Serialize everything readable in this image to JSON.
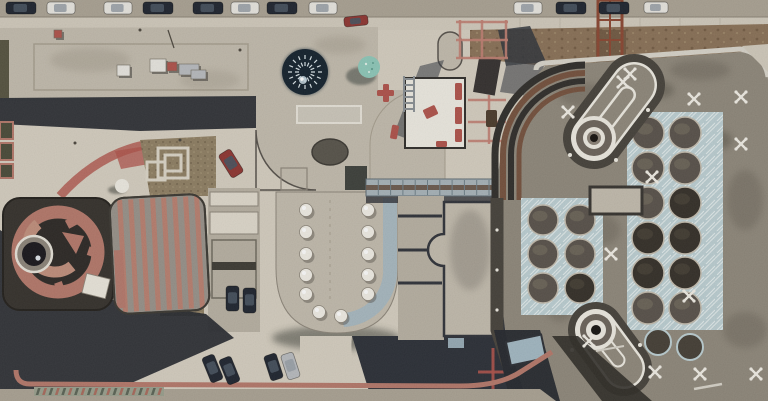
{
  "meta": {
    "title": "Aerial rooftop view of museum complex",
    "description": "Top-down drone photograph of a building complex: concrete rooftops, a dark radial skylight dome, a teal dome, a spiral rotunda on a dark square roof, a pink-striped barrel hall, a U-shaped roof with bubble skylights, a glass bridge, and a large taupe roof with keyhole-shaped structures, dome skylight grids with pale blue patterned spandrels and white X markers. Cars are parked along the top street and lower plaza."
  },
  "palette": {
    "plaza": "#d6cfc1",
    "plaza_bright": "#e0dacd",
    "concrete": "#c3bcae",
    "concrete2": "#b8b1a3",
    "street": "#aba394",
    "sidewalk": "#d2cbbd",
    "shadow": "#23262c",
    "navy": "#2a2e36",
    "roof_taupe": "#8f887b",
    "roof_dark": "#45413a",
    "terracotta": "#b5786a",
    "pink": "#bb7e6e",
    "red_paint": "#b0524a",
    "red_line": "#c17f72",
    "brick_red": "#8f3430",
    "dirt": "#8a7157",
    "dirt_dark": "#6e5640",
    "teal": "#8ec9ba",
    "dome_navy": "#12202c",
    "blue_pattern": "#bdd0d4",
    "blue_glass": "#a3b9c4",
    "white": "#efece3",
    "car_dark": "#1d232e",
    "car_white": "#e9e7e1",
    "car_silver": "#b9bcc0",
    "rust": "#8a4530",
    "gravel": "#8f7f63",
    "charcoal": "#2e2c29",
    "brown_stripe": "#74503c",
    "silver_edge": "#d9d5cb",
    "hall_gray": "#98928a"
  },
  "scene": {
    "cars": [
      {
        "x": 6,
        "y": 2,
        "w": 30,
        "h": 12,
        "a": 0,
        "color": "car_dark"
      },
      {
        "x": 47,
        "y": 2,
        "w": 28,
        "h": 12,
        "a": 0,
        "color": "car_white"
      },
      {
        "x": 104,
        "y": 2,
        "w": 28,
        "h": 12,
        "a": 0,
        "color": "car_white"
      },
      {
        "x": 143,
        "y": 2,
        "w": 30,
        "h": 12,
        "a": 0,
        "color": "car_dark"
      },
      {
        "x": 193,
        "y": 2,
        "w": 30,
        "h": 12,
        "a": 0,
        "color": "car_dark"
      },
      {
        "x": 231,
        "y": 2,
        "w": 28,
        "h": 12,
        "a": 0,
        "color": "car_white"
      },
      {
        "x": 267,
        "y": 2,
        "w": 30,
        "h": 12,
        "a": 0,
        "color": "car_dark"
      },
      {
        "x": 309,
        "y": 2,
        "w": 28,
        "h": 12,
        "a": 0,
        "color": "car_white"
      },
      {
        "x": 514,
        "y": 2,
        "w": 28,
        "h": 12,
        "a": 0,
        "color": "car_white"
      },
      {
        "x": 556,
        "y": 2,
        "w": 30,
        "h": 12,
        "a": 0,
        "color": "car_dark"
      },
      {
        "x": 599,
        "y": 2,
        "w": 30,
        "h": 12,
        "a": 0,
        "color": "car_dark"
      },
      {
        "x": 644,
        "y": 2,
        "w": 24,
        "h": 11,
        "a": 0,
        "color": "car_white"
      },
      {
        "x": 344,
        "y": 16,
        "w": 24,
        "h": 10,
        "a": -6,
        "color": "brick_red"
      },
      {
        "x": 224,
        "y": 150,
        "w": 14,
        "h": 27,
        "a": -32,
        "color": "brick_red"
      },
      {
        "x": 226,
        "y": 286,
        "w": 13,
        "h": 25,
        "a": 0,
        "color": "car_dark"
      },
      {
        "x": 243,
        "y": 288,
        "w": 13,
        "h": 25,
        "a": 0,
        "color": "car_dark"
      },
      {
        "x": 206,
        "y": 355,
        "w": 13,
        "h": 27,
        "a": -22,
        "color": "car_dark"
      },
      {
        "x": 223,
        "y": 357,
        "w": 13,
        "h": 27,
        "a": -22,
        "color": "car_dark"
      },
      {
        "x": 267,
        "y": 354,
        "w": 13,
        "h": 26,
        "a": -18,
        "color": "car_dark"
      },
      {
        "x": 284,
        "y": 353,
        "w": 13,
        "h": 26,
        "a": -18,
        "color": "car_silver"
      }
    ],
    "hvac_units": [
      {
        "x": 150,
        "y": 59,
        "w": 16,
        "h": 13,
        "color": "car_white"
      },
      {
        "x": 167,
        "y": 62,
        "w": 10,
        "h": 9,
        "color": "red_paint"
      },
      {
        "x": 179,
        "y": 64,
        "w": 20,
        "h": 11,
        "color": "car_silver"
      },
      {
        "x": 191,
        "y": 70,
        "w": 15,
        "h": 9,
        "color": "car_silver"
      },
      {
        "x": 117,
        "y": 65,
        "w": 13,
        "h": 11,
        "color": "car_white"
      },
      {
        "x": 54,
        "y": 30,
        "w": 8,
        "h": 8,
        "color": "red_paint"
      }
    ],
    "striped_hall": {
      "x0": 120,
      "step": 11,
      "count": 8,
      "y": 198,
      "h": 112,
      "w": 5
    },
    "dome_spokes": {
      "cx": 305,
      "cy": 72,
      "r": 23,
      "count": 16
    },
    "skylight_bubbles": {
      "left_x": 306,
      "right_x": 368,
      "rows": [
        210,
        232,
        254,
        275,
        294
      ],
      "arc": [
        [
          319,
          312
        ],
        [
          341,
          316
        ]
      ],
      "radius": 6.5
    },
    "dome_clusters": [
      {
        "field": [
          521,
          198,
          82,
          117
        ],
        "cols": [
          543,
          580
        ],
        "rows": [
          220,
          254,
          288
        ],
        "r": 15,
        "sooty": [
          [
            580,
            288
          ]
        ]
      },
      {
        "field": [
          627,
          112,
          96,
          218
        ],
        "cols": [
          648,
          685
        ],
        "rows": [
          133,
          168,
          203,
          238,
          273,
          308
        ],
        "r": 16,
        "sooty": [
          [
            648,
            238
          ],
          [
            685,
            238
          ],
          [
            648,
            273
          ],
          [
            685,
            273
          ],
          [
            685,
            203
          ]
        ]
      }
    ],
    "extra_domes": [
      [
        658,
        342
      ],
      [
        690,
        347
      ]
    ],
    "x_marks": [
      [
        623,
        82
      ],
      [
        694,
        99
      ],
      [
        741,
        97
      ],
      [
        741,
        144
      ],
      [
        652,
        177
      ],
      [
        568,
        112
      ],
      [
        630,
        74
      ],
      [
        689,
        296
      ],
      [
        655,
        372
      ],
      [
        700,
        374
      ],
      [
        756,
        374
      ],
      [
        589,
        341
      ],
      [
        611,
        254
      ]
    ],
    "red_furniture": [
      {
        "x": 377,
        "y": 90,
        "w": 17,
        "h": 6,
        "a": 0
      },
      {
        "x": 383,
        "y": 84,
        "w": 6,
        "h": 18,
        "a": 0
      },
      {
        "x": 455,
        "y": 83,
        "w": 7,
        "h": 17,
        "a": 0
      },
      {
        "x": 455,
        "y": 107,
        "w": 7,
        "h": 17,
        "a": 0
      },
      {
        "x": 455,
        "y": 129,
        "w": 7,
        "h": 13,
        "a": 0
      },
      {
        "x": 424,
        "y": 107,
        "w": 13,
        "h": 10,
        "a": -25
      },
      {
        "x": 391,
        "y": 125,
        "w": 7,
        "h": 14,
        "a": 10
      },
      {
        "x": 436,
        "y": 141,
        "w": 11,
        "h": 6,
        "a": 0
      }
    ],
    "red_grid": {
      "verticals": [
        [
          460,
          20,
          58
        ],
        [
          482,
          20,
          58
        ],
        [
          506,
          20,
          58
        ],
        [
          489,
          95,
          144
        ]
      ],
      "horizontals": [
        [
          456,
          508,
          22
        ],
        [
          456,
          508,
          40
        ],
        [
          456,
          508,
          58
        ],
        [
          468,
          506,
          100
        ],
        [
          468,
          506,
          122
        ],
        [
          468,
          506,
          141
        ]
      ]
    },
    "crosswalk": {
      "x": 36,
      "y": 387,
      "count": 20,
      "step": 6.4
    },
    "ladder": {
      "x": 404,
      "y": 76,
      "w": 10,
      "h": 36,
      "rungs": 6
    }
  }
}
